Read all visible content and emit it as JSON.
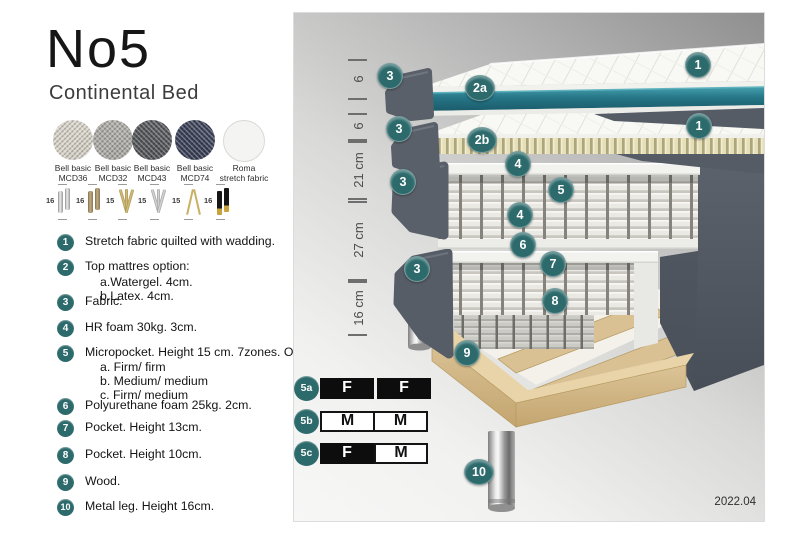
{
  "header": {
    "title": "No5",
    "subtitle": "Continental Bed"
  },
  "fabrics": [
    {
      "line1": "Bell basic",
      "line2": "MCD36",
      "color": "#d9d5ca"
    },
    {
      "line1": "Bell basic",
      "line2": "MCD32",
      "color": "#aeaca6"
    },
    {
      "line1": "Bell basic",
      "line2": "MCD43",
      "color": "#55565a"
    },
    {
      "line1": "Bell basic",
      "line2": "MCD74",
      "color": "#3a4057"
    },
    {
      "line1": "Roma",
      "line2": "stretch fabric",
      "color": "#f4f4f2"
    }
  ],
  "legs": [
    {
      "height": "16",
      "type": "chrome-cylinder"
    },
    {
      "height": "16",
      "type": "bronze-cylinder"
    },
    {
      "height": "15",
      "type": "gold-twist"
    },
    {
      "height": "15",
      "type": "silver-twist"
    },
    {
      "height": "15",
      "type": "gold-hairpin"
    },
    {
      "height": "16",
      "type": "black-gold"
    }
  ],
  "list": [
    {
      "num": "1",
      "text": "Stretch fabric quilted with wadding.",
      "sub": []
    },
    {
      "num": "2",
      "text": "Top mattres option:",
      "sub": [
        "a.Watergel. 4cm.",
        "b.Latex. 4cm."
      ]
    },
    {
      "num": "3",
      "text": "Fabric.",
      "sub": []
    },
    {
      "num": "4",
      "text": "HR foam 30kg. 3cm.",
      "sub": []
    },
    {
      "num": "5",
      "text": "Micropocket. Height 15 cm. 7zones. Option:",
      "sub": [
        "a. Firm/ firm",
        "b. Medium/ medium",
        "c. Firm/ medium"
      ]
    },
    {
      "num": "6",
      "text": "Polyurethane foam 25kg. 2cm.",
      "sub": []
    },
    {
      "num": "7",
      "text": "Pocket. Height 13cm.",
      "sub": []
    },
    {
      "num": "8",
      "text": "Pocket. Height 10cm.",
      "sub": []
    },
    {
      "num": "9",
      "text": "Wood.",
      "sub": []
    },
    {
      "num": "10",
      "text": "Metal leg. Height 16cm.",
      "sub": []
    }
  ],
  "diagram": {
    "version": "2022.04",
    "scale": [
      {
        "label": "6",
        "from": 46,
        "to": 85
      },
      {
        "label": "6",
        "from": 100,
        "to": 126
      },
      {
        "label": "21 cm",
        "from": 128,
        "to": 185
      },
      {
        "label": "27 cm",
        "from": 188,
        "to": 266
      },
      {
        "label": "16 cm",
        "from": 268,
        "to": 321
      }
    ],
    "callouts": [
      {
        "label": "1",
        "x": 403,
        "y": 51
      },
      {
        "label": "3",
        "x": 95,
        "y": 62
      },
      {
        "label": "2a",
        "x": 185,
        "y": 74
      },
      {
        "label": "3",
        "x": 104,
        "y": 115
      },
      {
        "label": "1",
        "x": 404,
        "y": 112
      },
      {
        "label": "2b",
        "x": 187,
        "y": 126
      },
      {
        "label": "4",
        "x": 223,
        "y": 150
      },
      {
        "label": "3",
        "x": 108,
        "y": 168
      },
      {
        "label": "5",
        "x": 266,
        "y": 176
      },
      {
        "label": "4",
        "x": 225,
        "y": 201
      },
      {
        "label": "6",
        "x": 228,
        "y": 231
      },
      {
        "label": "7",
        "x": 258,
        "y": 250
      },
      {
        "label": "3",
        "x": 122,
        "y": 255
      },
      {
        "label": "8",
        "x": 260,
        "y": 287
      },
      {
        "label": "9",
        "x": 172,
        "y": 339
      },
      {
        "label": "10",
        "x": 184,
        "y": 458
      }
    ],
    "firmness": [
      {
        "id": "5a",
        "cells": [
          {
            "t": "F",
            "style": "dark"
          },
          {
            "t": "F",
            "style": "dark"
          }
        ]
      },
      {
        "id": "5b",
        "cells": [
          {
            "t": "M",
            "style": "light"
          },
          {
            "t": "M",
            "style": "light"
          }
        ]
      },
      {
        "id": "5c",
        "cells": [
          {
            "t": "F",
            "style": "dark"
          },
          {
            "t": "M",
            "style": "light"
          }
        ]
      }
    ]
  },
  "colors": {
    "accent": "#2d6a6c",
    "teal_layer": "#2a7c8d",
    "fabric_dark": "#565c66",
    "latex": "#e3dcb4",
    "wood": "#d8c092",
    "chrome": "#c0c0c0"
  }
}
